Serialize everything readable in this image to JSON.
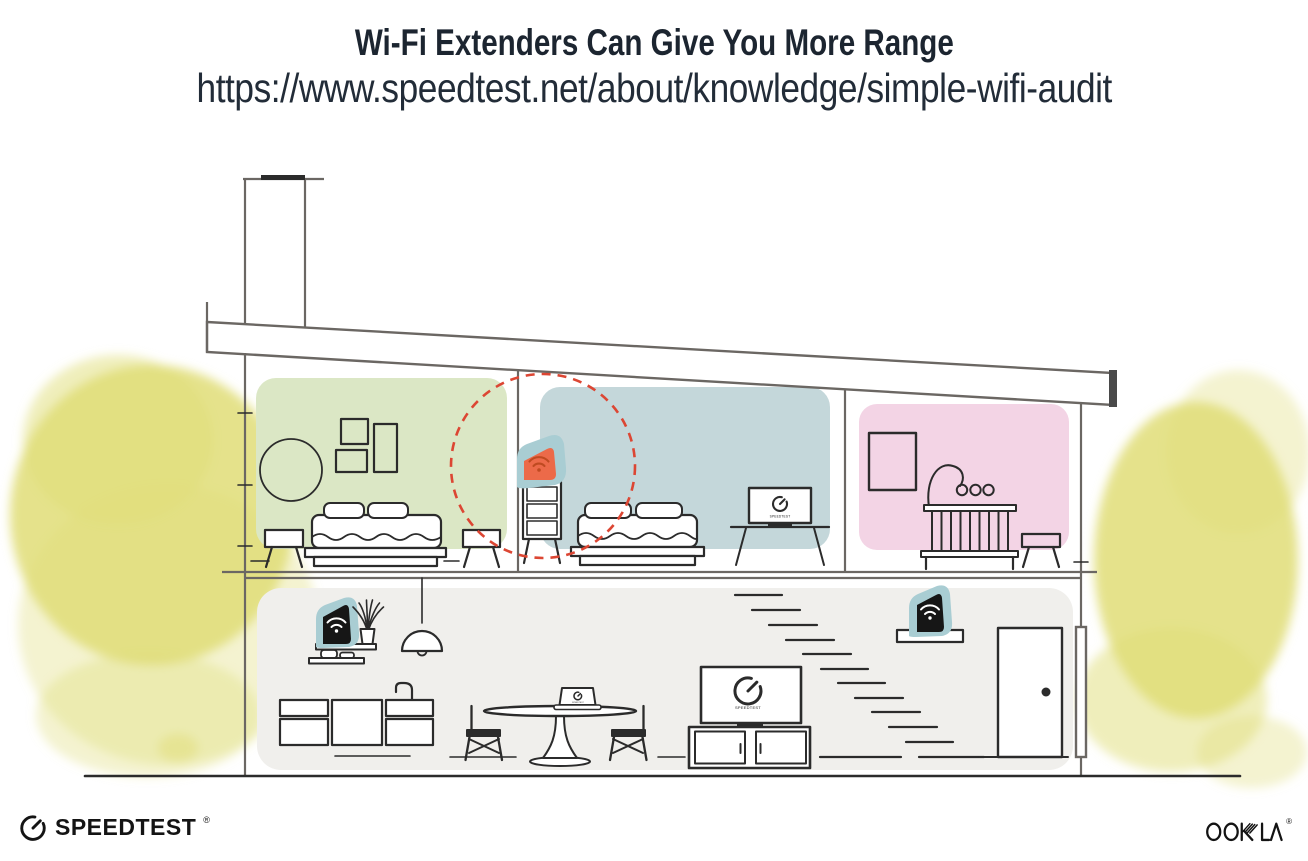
{
  "header": {
    "title": "Wi-Fi Extenders Can Give You More Range",
    "url": "https://www.speedtest.net/about/knowledge/simple-wifi-audit"
  },
  "illustration": {
    "tv_label": "SPEEDTEST",
    "icons": {
      "wifi": "wifi-icon",
      "gauge": "speedtest-gauge-icon"
    },
    "colors": {
      "text_dark": "#1c2530",
      "room_green": "#dbe7c5",
      "room_blue": "#c4d7da",
      "room_pink": "#f3d4e5",
      "floor_gray": "#f0efec",
      "foliage_yellow": "#e0dd77",
      "accent_teal": "#a9cdd3",
      "accent_coral": "#ec6a49",
      "wifi_icon_red": "#bf4a21",
      "device_black": "#161616",
      "range_circle_red": "#dc4633",
      "line_dark": "#2b2b2b",
      "wall_gray": "#6b6763"
    }
  },
  "footer": {
    "speedtest": {
      "label": "SPEEDTEST",
      "trademark": "®"
    },
    "ookla": {
      "label": "OOKLA",
      "trademark": "®"
    }
  }
}
